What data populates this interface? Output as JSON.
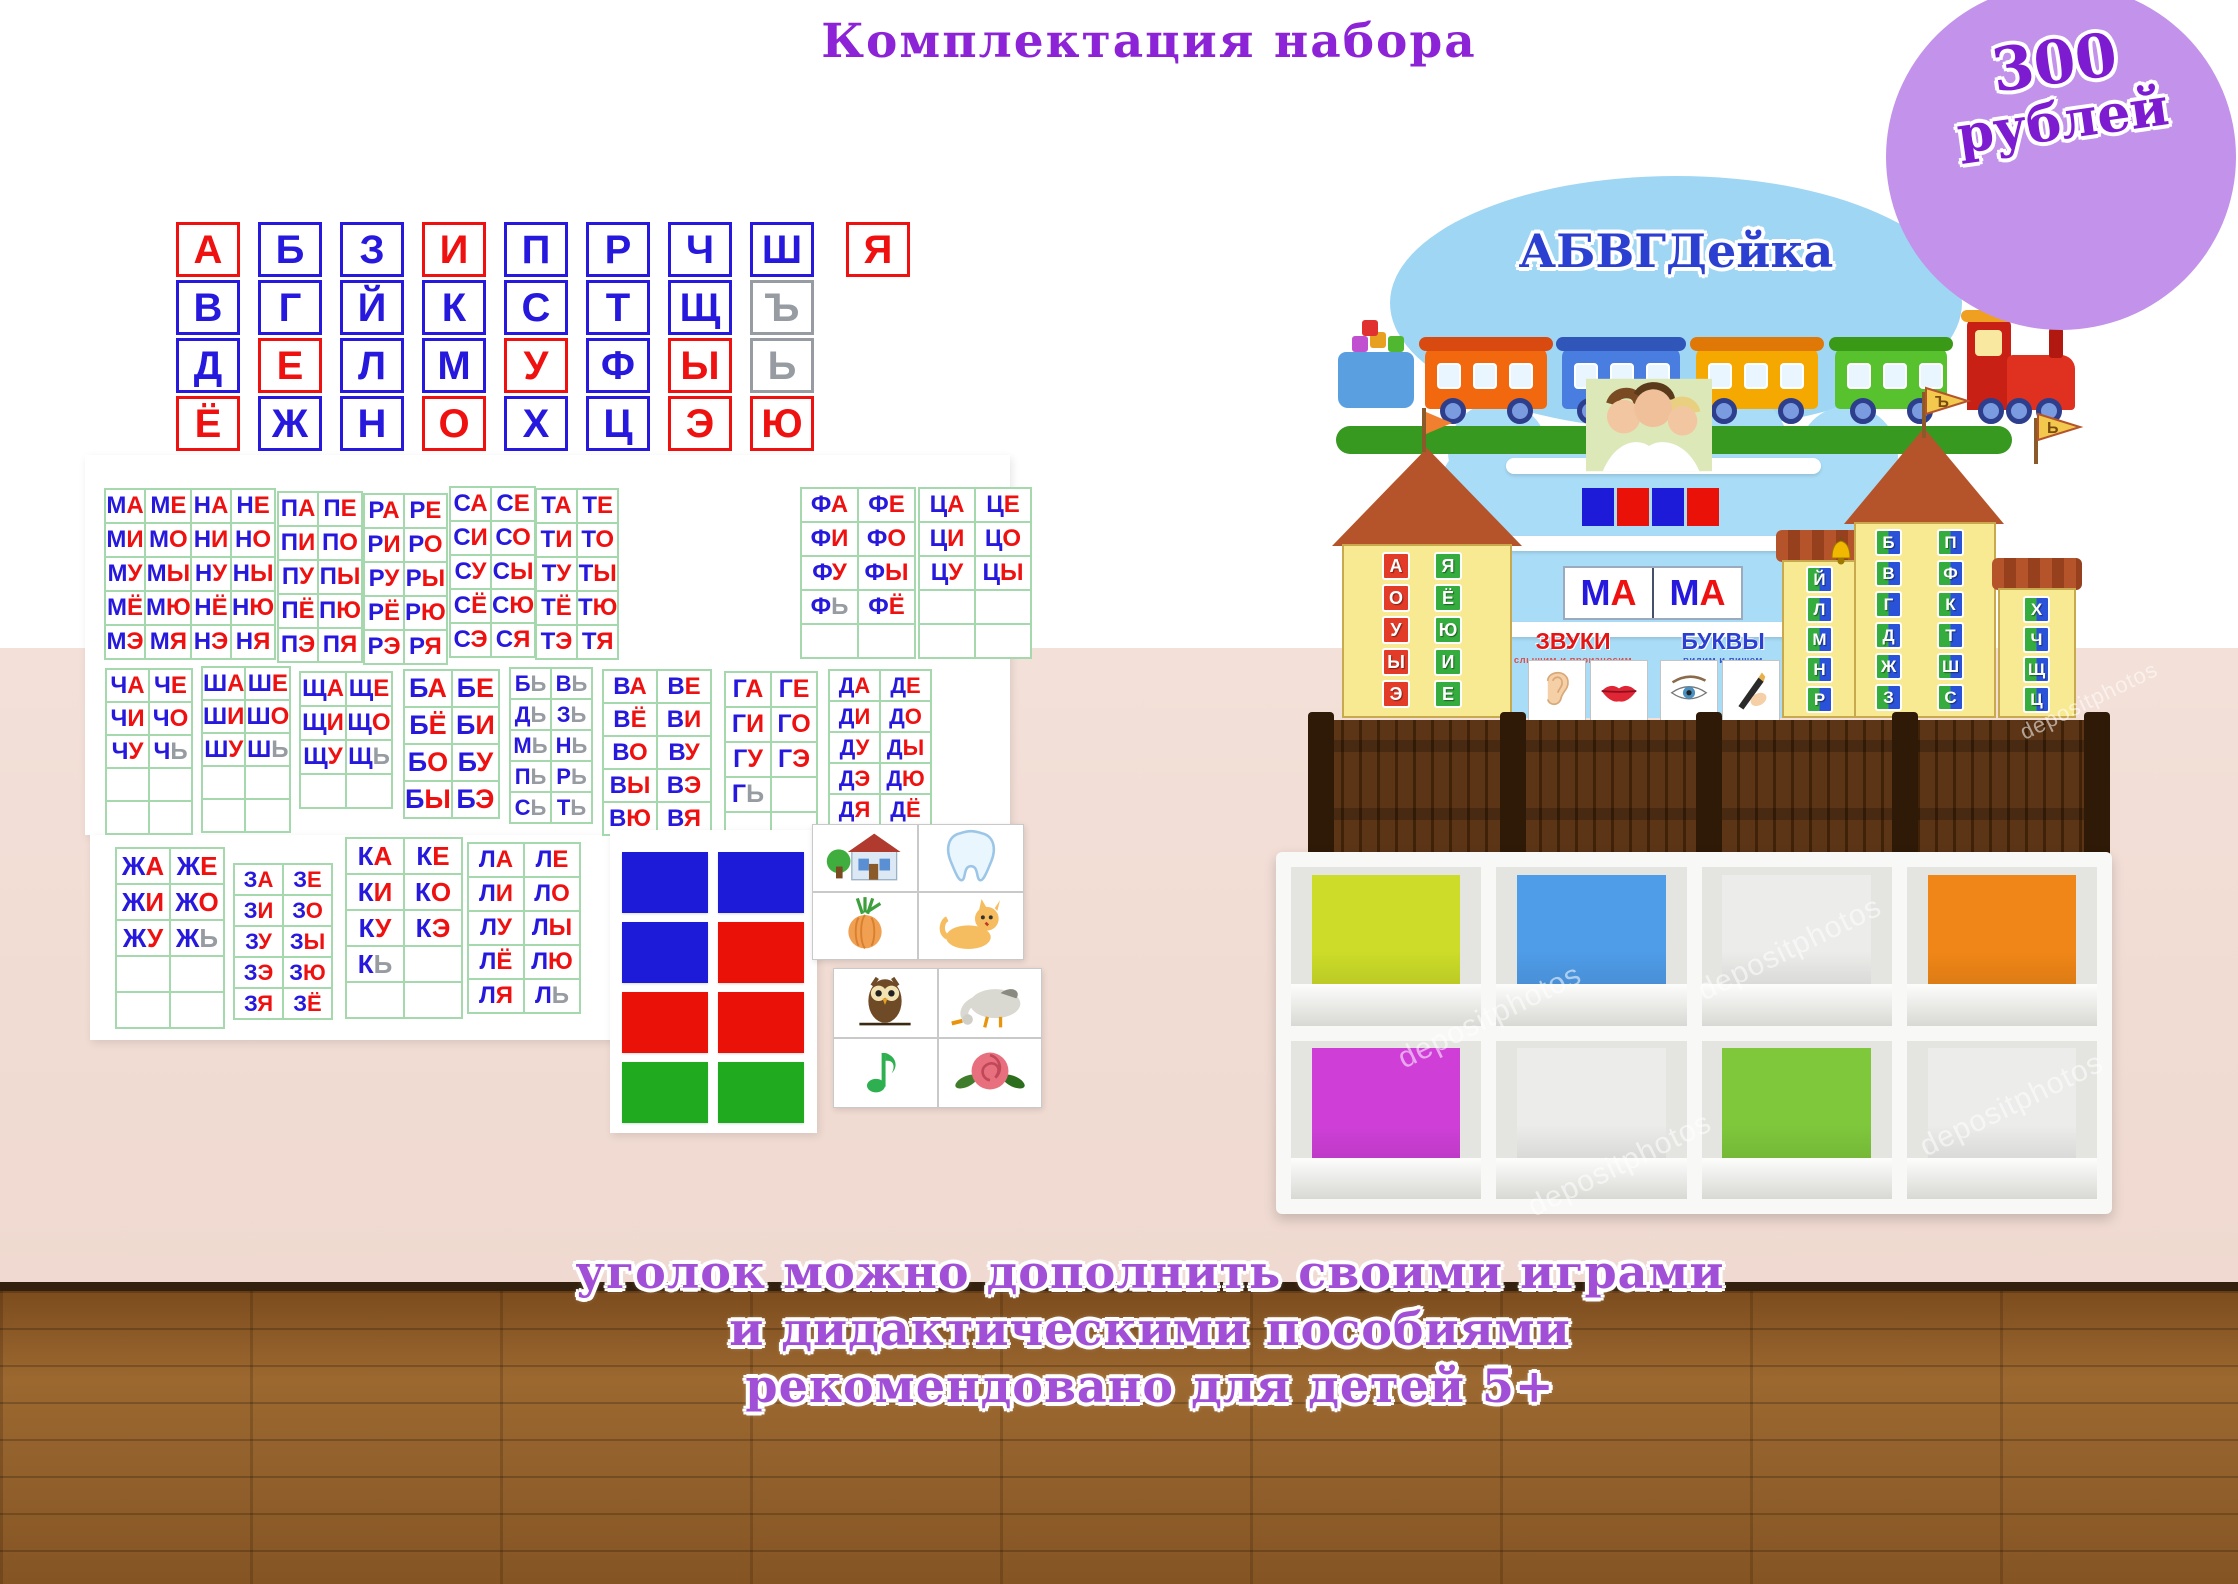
{
  "title": "Комплектация набора",
  "price_badge": {
    "amount": "300",
    "currency": "рублей"
  },
  "footer_lines": [
    "уголок можно дополнить своими играми",
    "и дидактическими пособиями",
    "рекомендовано для детей 5+"
  ],
  "watermark": "depositphotos",
  "palette": {
    "red": "#ef1010",
    "blue": "#2618dc",
    "gray": "#979ca2",
    "accent_purple": "#8d23d6",
    "badge_purple": "#c392ea",
    "sq_blue": "#1d1bd8",
    "sq_red": "#ea1108",
    "sq_green": "#1faa1f",
    "tile_red": "#e23b28",
    "tile_green": "#35ac3e",
    "tile_blue": "#2a52d8"
  },
  "letter_cards": {
    "rows": [
      [
        [
          "А",
          "r"
        ],
        [
          "Б",
          "b"
        ],
        [
          "З",
          "b"
        ],
        [
          "И",
          "r"
        ],
        [
          "П",
          "b"
        ],
        [
          "Р",
          "b"
        ],
        [
          "Ч",
          "b"
        ],
        [
          "Ш",
          "b"
        ],
        [
          "Я",
          "r"
        ]
      ],
      [
        [
          "В",
          "b"
        ],
        [
          "Г",
          "b"
        ],
        [
          "Й",
          "b"
        ],
        [
          "К",
          "b"
        ],
        [
          "С",
          "b"
        ],
        [
          "Т",
          "b"
        ],
        [
          "Щ",
          "b"
        ],
        [
          "Ъ",
          "g"
        ]
      ],
      [
        [
          "Д",
          "b"
        ],
        [
          "Е",
          "r"
        ],
        [
          "Л",
          "b"
        ],
        [
          "М",
          "b"
        ],
        [
          "У",
          "r"
        ],
        [
          "Ф",
          "b"
        ],
        [
          "Ы",
          "r"
        ],
        [
          "Ь",
          "g"
        ]
      ],
      [
        [
          "Ё",
          "r"
        ],
        [
          "Ж",
          "b"
        ],
        [
          "Н",
          "b"
        ],
        [
          "О",
          "r"
        ],
        [
          "Х",
          "b"
        ],
        [
          "Ц",
          "b"
        ],
        [
          "Э",
          "r"
        ],
        [
          "Ю",
          "r"
        ]
      ]
    ]
  },
  "syllable_tables": [
    {
      "id": "M",
      "rows": [
        [
          "МА",
          "МЕ"
        ],
        [
          "МИ",
          "МО"
        ],
        [
          "МУ",
          "МЫ"
        ],
        [
          "МЁ",
          "МЮ"
        ],
        [
          "МЭ",
          "МЯ"
        ]
      ]
    },
    {
      "id": "N",
      "rows": [
        [
          "НА",
          "НЕ"
        ],
        [
          "НИ",
          "НО"
        ],
        [
          "НУ",
          "НЫ"
        ],
        [
          "НЁ",
          "НЮ"
        ],
        [
          "НЭ",
          "НЯ"
        ]
      ]
    },
    {
      "id": "P",
      "rows": [
        [
          "ПА",
          "ПЕ"
        ],
        [
          "ПИ",
          "ПО"
        ],
        [
          "ПУ",
          "ПЫ"
        ],
        [
          "ПЁ",
          "ПЮ"
        ],
        [
          "ПЭ",
          "ПЯ"
        ]
      ]
    },
    {
      "id": "R",
      "rows": [
        [
          "РА",
          "РЕ"
        ],
        [
          "РИ",
          "РО"
        ],
        [
          "РУ",
          "РЫ"
        ],
        [
          "РЁ",
          "РЮ"
        ],
        [
          "РЭ",
          "РЯ"
        ]
      ]
    },
    {
      "id": "S",
      "rows": [
        [
          "СА",
          "СЕ"
        ],
        [
          "СИ",
          "СО"
        ],
        [
          "СУ",
          "СЫ"
        ],
        [
          "СЁ",
          "СЮ"
        ],
        [
          "СЭ",
          "СЯ"
        ]
      ]
    },
    {
      "id": "T",
      "rows": [
        [
          "ТА",
          "ТЕ"
        ],
        [
          "ТИ",
          "ТО"
        ],
        [
          "ТУ",
          "ТЫ"
        ],
        [
          "ТЁ",
          "ТЮ"
        ],
        [
          "ТЭ",
          "ТЯ"
        ]
      ]
    },
    {
      "id": "F",
      "rows": [
        [
          "ФА",
          "ФЕ"
        ],
        [
          "ФИ",
          "ФО"
        ],
        [
          "ФУ",
          "ФЫ"
        ],
        [
          "ФЬ",
          "ФЁ"
        ],
        [
          "",
          ""
        ]
      ]
    },
    {
      "id": "C",
      "rows": [
        [
          "ЦА",
          "ЦЕ"
        ],
        [
          "ЦИ",
          "ЦО"
        ],
        [
          "ЦУ",
          "ЦЫ"
        ],
        [
          "",
          ""
        ],
        [
          "",
          ""
        ]
      ]
    },
    {
      "id": "CH",
      "rows": [
        [
          "ЧА",
          "ЧЕ"
        ],
        [
          "ЧИ",
          "ЧО"
        ],
        [
          "ЧУ",
          "ЧЬ"
        ],
        [
          "",
          ""
        ],
        [
          "",
          ""
        ]
      ]
    },
    {
      "id": "SH",
      "rows": [
        [
          "ША",
          "ШЕ"
        ],
        [
          "ШИ",
          "ШО"
        ],
        [
          "ШУ",
          "ШЬ"
        ],
        [
          "",
          ""
        ],
        [
          "",
          ""
        ]
      ]
    },
    {
      "id": "SCH",
      "rows": [
        [
          "ЩА",
          "ЩЕ"
        ],
        [
          "ЩИ",
          "ЩО"
        ],
        [
          "ЩУ",
          "ЩЬ"
        ],
        [
          "",
          ""
        ]
      ]
    },
    {
      "id": "B",
      "rows": [
        [
          "БА",
          "БЕ"
        ],
        [
          "БЁ",
          "БИ"
        ],
        [
          "БО",
          "БУ"
        ],
        [
          "БЫ",
          "БЭ"
        ]
      ]
    },
    {
      "id": "SOFT",
      "rows": [
        [
          "БЬ",
          "ВЬ"
        ],
        [
          "ДЬ",
          "ЗЬ"
        ],
        [
          "МЬ",
          "НЬ"
        ],
        [
          "ПЬ",
          "РЬ"
        ],
        [
          "СЬ",
          "ТЬ"
        ]
      ]
    },
    {
      "id": "V",
      "rows": [
        [
          "ВА",
          "ВЕ"
        ],
        [
          "ВЁ",
          "ВИ"
        ],
        [
          "ВО",
          "ВУ"
        ],
        [
          "ВЫ",
          "ВЭ"
        ],
        [
          "ВЮ",
          "ВЯ"
        ]
      ]
    },
    {
      "id": "G",
      "rows": [
        [
          "ГА",
          "ГЕ"
        ],
        [
          "ГИ",
          "ГО"
        ],
        [
          "ГУ",
          "ГЭ"
        ],
        [
          "ГЬ",
          ""
        ],
        [
          "",
          ""
        ]
      ]
    },
    {
      "id": "D",
      "rows": [
        [
          "ДА",
          "ДЕ"
        ],
        [
          "ДИ",
          "ДО"
        ],
        [
          "ДУ",
          "ДЫ"
        ],
        [
          "ДЭ",
          "ДЮ"
        ],
        [
          "ДЯ",
          "ДЁ"
        ]
      ]
    },
    {
      "id": "ZH",
      "rows": [
        [
          "ЖА",
          "ЖЕ"
        ],
        [
          "ЖИ",
          "ЖО"
        ],
        [
          "ЖУ",
          "ЖЬ"
        ],
        [
          "",
          ""
        ],
        [
          "",
          ""
        ]
      ]
    },
    {
      "id": "Z",
      "rows": [
        [
          "ЗА",
          "ЗЕ"
        ],
        [
          "ЗИ",
          "ЗО"
        ],
        [
          "ЗУ",
          "ЗЫ"
        ],
        [
          "ЗЭ",
          "ЗЮ"
        ],
        [
          "ЗЯ",
          "ЗЁ"
        ]
      ]
    },
    {
      "id": "K",
      "rows": [
        [
          "КА",
          "КЕ"
        ],
        [
          "КИ",
          "КО"
        ],
        [
          "КУ",
          "КЭ"
        ],
        [
          "КЬ",
          ""
        ],
        [
          "",
          ""
        ]
      ]
    },
    {
      "id": "L",
      "rows": [
        [
          "ЛА",
          "ЛЕ"
        ],
        [
          "ЛИ",
          "ЛО"
        ],
        [
          "ЛУ",
          "ЛЫ"
        ],
        [
          "ЛЁ",
          "ЛЮ"
        ],
        [
          "ЛЯ",
          "ЛЬ"
        ]
      ]
    }
  ],
  "color_card": {
    "rows": [
      [
        "sq_blue",
        "sq_blue"
      ],
      [
        "sq_blue",
        "sq_red"
      ],
      [
        "sq_red",
        "sq_red"
      ],
      [
        "sq_green",
        "sq_green"
      ]
    ]
  },
  "picture_cards": [
    {
      "cells": [
        "house",
        "tooth",
        "onion",
        "cat"
      ]
    },
    {
      "cells": [
        "owl",
        "goose",
        "music-note",
        "rose"
      ]
    }
  ],
  "board": {
    "title": "АБВГДейка",
    "word_left": "МА",
    "word_right": "МА",
    "sound_squares": [
      "sq_blue",
      "sq_red",
      "sq_blue",
      "sq_red"
    ],
    "sounds_label": "ЗВУКИ",
    "sounds_sub": "слышим и произносим",
    "letters_label": "БУКВЫ",
    "letters_sub": "видим и пишем",
    "sense_icons": [
      "ear",
      "lips",
      "eye",
      "writing-hand"
    ],
    "left_house": {
      "col1": [
        "А",
        "О",
        "У",
        "Ы",
        "Э"
      ],
      "col2": [
        "Я",
        "Ё",
        "Ю",
        "И",
        "Е"
      ]
    },
    "mid_house": [
      "Й",
      "Л",
      "М",
      "Н",
      "Р"
    ],
    "tall_house": {
      "col1": [
        "Б",
        "В",
        "Г",
        "Д",
        "Ж",
        "З"
      ],
      "col2": [
        "П",
        "Ф",
        "К",
        "Т",
        "Ш",
        "С"
      ]
    },
    "right_house": [
      "Х",
      "Ч",
      "Щ",
      "Ц"
    ],
    "flags": [
      "Ъ",
      "Ь"
    ]
  },
  "shelf": {
    "cells": [
      "#ccdc28",
      "#4f9ce8",
      "#ececea",
      "#f08617",
      "#cf3fd8",
      "#ececea",
      "#7fc83c",
      "#ececea"
    ]
  }
}
